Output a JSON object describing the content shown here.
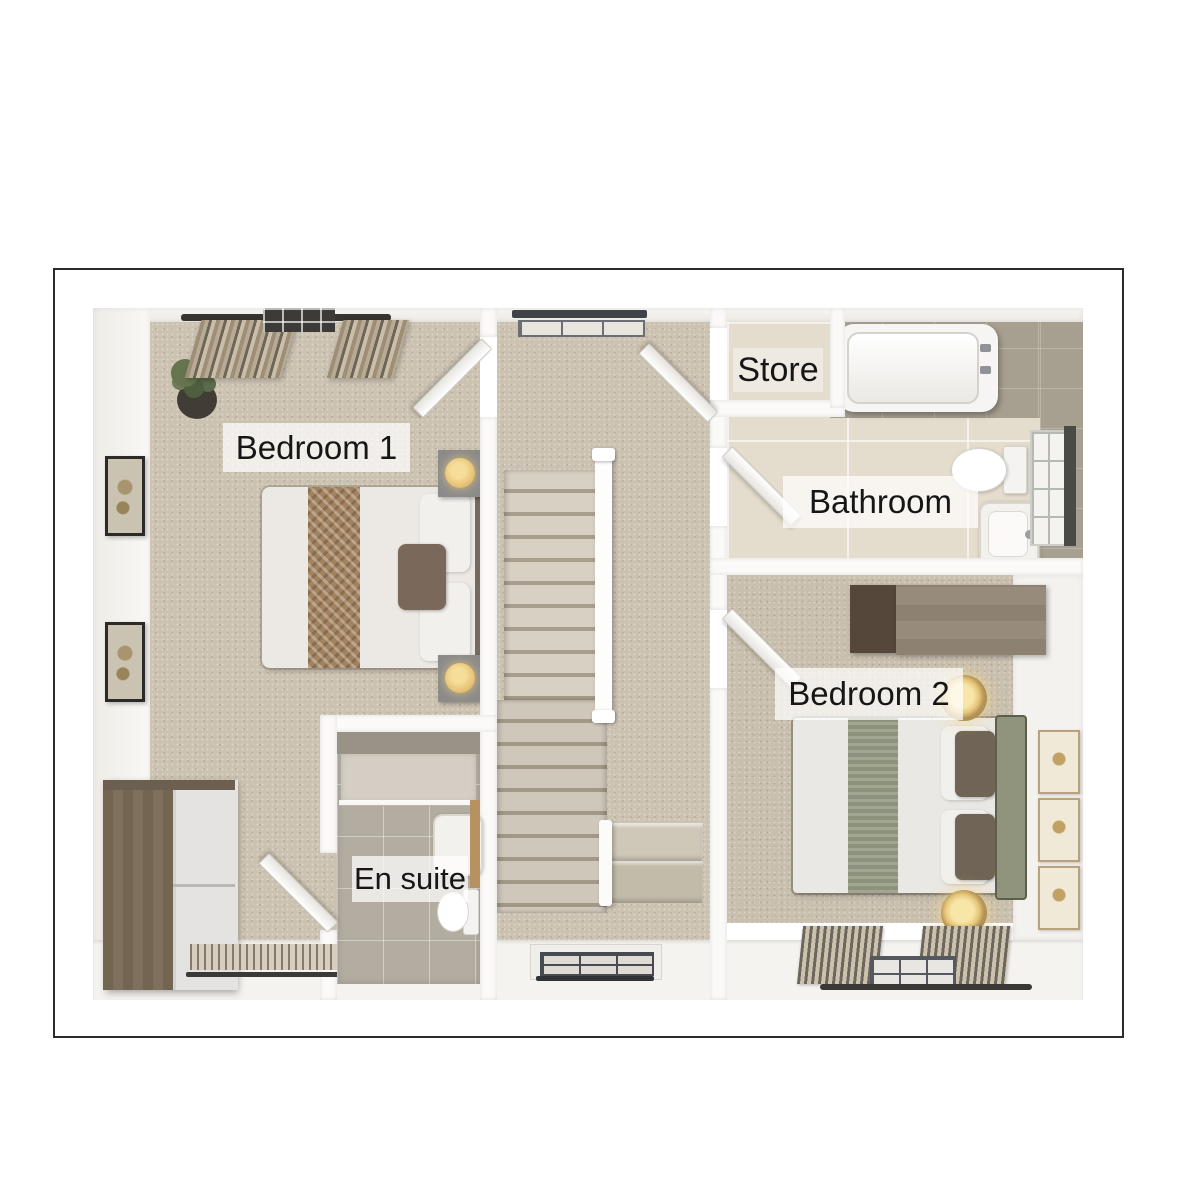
{
  "plan": {
    "rooms": [
      {
        "id": "bedroom-1",
        "label": "Bedroom 1"
      },
      {
        "id": "store",
        "label": "Store"
      },
      {
        "id": "bathroom",
        "label": "Bathroom"
      },
      {
        "id": "bedroom-2",
        "label": "Bedroom 2"
      },
      {
        "id": "en-suite",
        "label": "En suite"
      }
    ],
    "colors": {
      "frame_border": "#2b2b2b",
      "wall": "#fbfaf8",
      "carpet": "#ccc2b1",
      "carpet_bedroom2": "#c9bfae",
      "bathroom_floor_tile": "#e4dccd",
      "bathroom_wall_tile": "#a79f90",
      "ensuite_floor_tile": "#b3aca1",
      "wood_light": "#8d8172",
      "wood_dark": "#55473a",
      "lamp_glow": "#eecd7f",
      "sage_green": "#8c927b",
      "throw_brown": "#a3835f",
      "label_text": "#161616",
      "label_background": "rgba(255,255,255,0.72)"
    }
  }
}
